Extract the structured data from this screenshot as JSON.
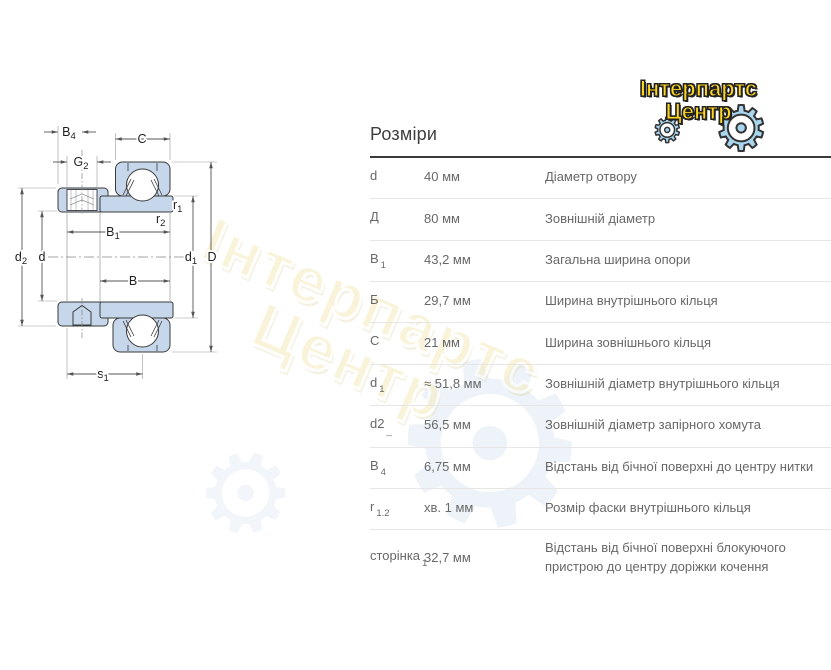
{
  "page": {
    "section_title": "Розміри"
  },
  "logo": {
    "line1": "Інтерпартс",
    "line2": "Центр",
    "text_color": "#ffd81e",
    "gear_color": "#a9d6ef"
  },
  "icons": {
    "gear": "⚙"
  },
  "watermark": {
    "line1": "Інтерпартс",
    "line2": "Центр"
  },
  "diagram": {
    "fill_color": "#c7d7eb",
    "labels": {
      "B4": {
        "main": "B",
        "sub": "4"
      },
      "G2": {
        "main": "G",
        "sub": "2"
      },
      "C": {
        "main": "C",
        "sub": ""
      },
      "r1": {
        "main": "r",
        "sub": "1"
      },
      "r2": {
        "main": "r",
        "sub": "2"
      },
      "B1": {
        "main": "B",
        "sub": "1"
      },
      "B": {
        "main": "B",
        "sub": ""
      },
      "d2": {
        "main": "d",
        "sub": "2"
      },
      "d": {
        "main": "d",
        "sub": ""
      },
      "d1": {
        "main": "d",
        "sub": "1"
      },
      "D": {
        "main": "D",
        "sub": ""
      },
      "s1": {
        "main": "s",
        "sub": "1"
      }
    }
  },
  "table": {
    "rows": [
      {
        "label": "d",
        "sub": "",
        "value": "40 мм",
        "desc": "Діаметр отвору"
      },
      {
        "label": "Д",
        "sub": "",
        "value": "80 мм",
        "desc": "Зовнішній діаметр"
      },
      {
        "label": "B",
        "sub": "1",
        "value": "43,2 мм",
        "desc": "Загальна ширина опори"
      },
      {
        "label": "Б",
        "sub": "",
        "value": "29,7 мм",
        "desc": "Ширина внутрішнього кільця"
      },
      {
        "label": "C",
        "sub": "",
        "value": "21 мм",
        "desc": "Ширина зовнішнього кільця"
      },
      {
        "label": "d",
        "sub": "1",
        "value": "≈ 51,8 мм",
        "desc": "Зовнішній діаметр внутрішнього кільця"
      },
      {
        "label": "d2",
        "sub": "_",
        "value": "56,5 мм",
        "desc": "Зовнішній діаметр запірного хомута"
      },
      {
        "label": "B",
        "sub": "4",
        "value": "6,75 мм",
        "desc": "Відстань від бічної поверхні до центру нитки"
      },
      {
        "label": "r",
        "sub": "1.2",
        "value": "хв. 1 мм",
        "desc": "Розмір фаски внутрішнього кільця"
      },
      {
        "label": "сторінка",
        "sub": "1",
        "value": "32,7 мм",
        "desc": "Відстань від бічної поверхні блокуючого пристрою до центру доріжки кочення"
      }
    ]
  }
}
